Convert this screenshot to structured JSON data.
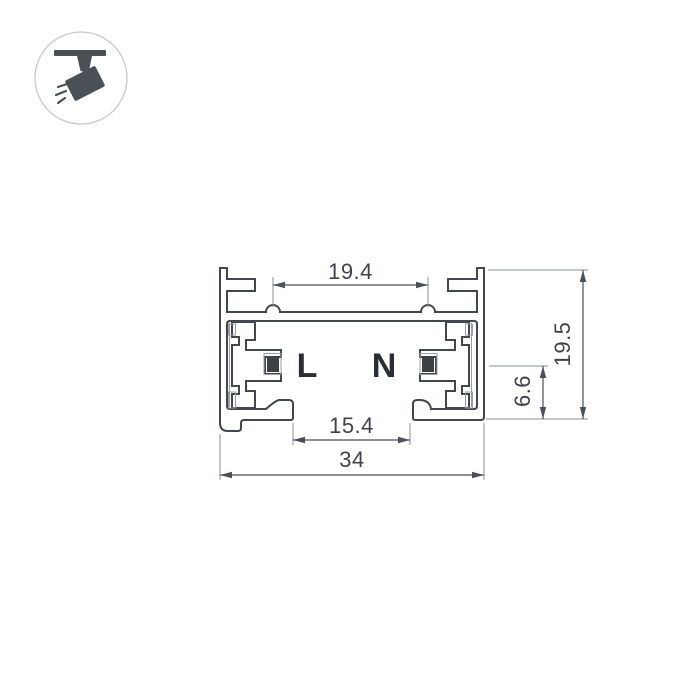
{
  "page": {
    "background_color": "#ffffff"
  },
  "logo": {
    "icon": "track-spotlight-icon",
    "glyph_color": "#4a5156",
    "circle_border_color": "#c6c8ca"
  },
  "drawing": {
    "type": "technical-cross-section",
    "subject": "track busbar profile",
    "line_color": "#42484d",
    "thin_line_color": "#8b9094",
    "insulator_line_color": "#9aa0a4",
    "conductor_fill": "#3c4246",
    "conductor_labels": {
      "live": "L",
      "neutral": "N"
    },
    "dimensions": {
      "top_width": "19.4",
      "opening_width": "15.4",
      "total_width": "34",
      "total_height": "19.5",
      "conductor_height": "6.6"
    }
  }
}
